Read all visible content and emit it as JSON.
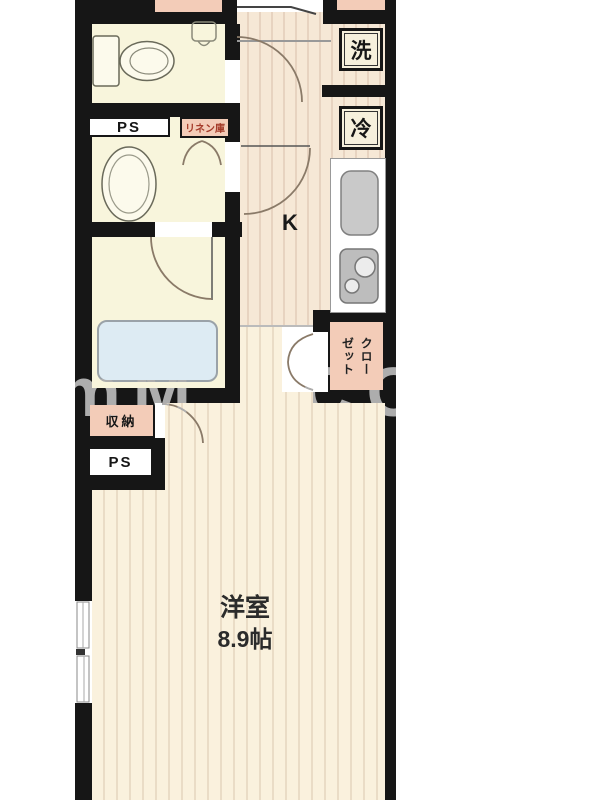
{
  "floorplan": {
    "labels": {
      "ps_top": "PS",
      "linen_cabinet": "リネン庫",
      "washer": "洗",
      "fridge": "冷",
      "kitchen": "K",
      "closet": "クローゼット",
      "closet_lines": [
        "クロー",
        "ゼット"
      ],
      "storage": "収納",
      "ps_bottom": "PS",
      "room_name": "洋室",
      "room_size": "8.9帖"
    },
    "watermark": {
      "left": "RmM",
      "right": "CO"
    },
    "colors": {
      "wall": "#161616",
      "floor_hall": "#F6E8D6",
      "floor_hall_line": "#E7D3C0",
      "floor_room": "#FAF1DD",
      "floor_room_line": "#EADCC6",
      "wetroom": "#F8F5DC",
      "accent_peach": "#F3CCB8",
      "box_bg": "#F6F0DC",
      "tub": "#DDEBF3",
      "linen_text": "#A43A28",
      "watermark": "#ADADAD"
    }
  }
}
